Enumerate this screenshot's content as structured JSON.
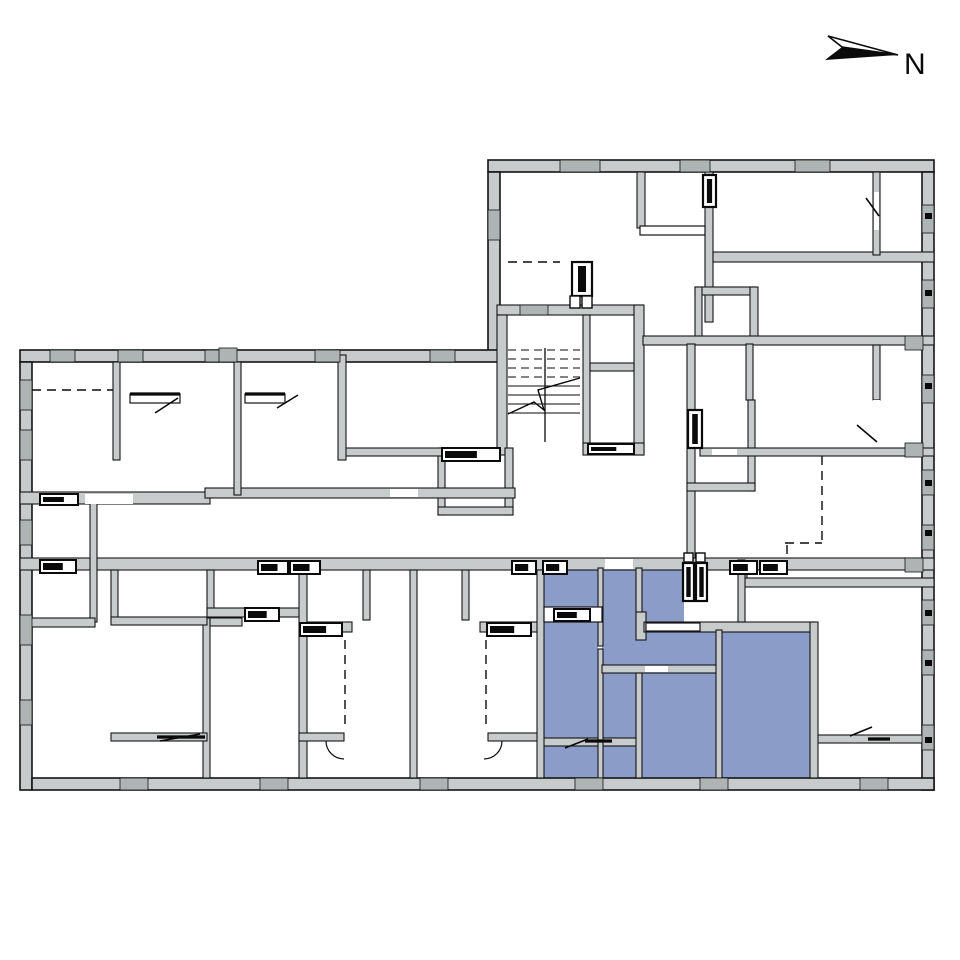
{
  "north": {
    "label": "N"
  },
  "colors": {
    "background": "#ffffff",
    "wall_fill": "#c7cbcc",
    "wall_outline": "#141414",
    "outer_window_fill": "#aeb3b4",
    "highlight": "#8c9cc9",
    "line_black": "#0a0a0a"
  },
  "plan": {
    "highlight_rects": [
      [
        544,
        570,
        140,
        52
      ],
      [
        544,
        622,
        54,
        116
      ],
      [
        602,
        622,
        114,
        50
      ],
      [
        602,
        672,
        36,
        66
      ],
      [
        642,
        672,
        74,
        106
      ],
      [
        722,
        630,
        88,
        148
      ],
      [
        544,
        742,
        96,
        36
      ]
    ],
    "outer_walls": [
      [
        488,
        160,
        446,
        12
      ],
      [
        922,
        172,
        12,
        618
      ],
      [
        488,
        172,
        12,
        180
      ],
      [
        20,
        350,
        478,
        12
      ],
      [
        20,
        362,
        12,
        428
      ],
      [
        32,
        778,
        902,
        12
      ]
    ],
    "inner_walls": [
      [
        497,
        305,
        145,
        10
      ],
      [
        497,
        315,
        10,
        140
      ],
      [
        583,
        315,
        7,
        130
      ],
      [
        634,
        305,
        10,
        150
      ],
      [
        590,
        363,
        44,
        8
      ],
      [
        583,
        443,
        61,
        12
      ],
      [
        438,
        448,
        7,
        67
      ],
      [
        505,
        448,
        8,
        67
      ],
      [
        438,
        507,
        75,
        8
      ],
      [
        342,
        448,
        104,
        8
      ],
      [
        637,
        172,
        8,
        56
      ],
      [
        705,
        172,
        8,
        150
      ],
      [
        713,
        252,
        221,
        10
      ],
      [
        873,
        172,
        7,
        83
      ],
      [
        695,
        287,
        60,
        8
      ],
      [
        695,
        287,
        7,
        57
      ],
      [
        750,
        287,
        8,
        57
      ],
      [
        643,
        336,
        291,
        9
      ],
      [
        687,
        344,
        8,
        216
      ],
      [
        746,
        344,
        7,
        56
      ],
      [
        748,
        400,
        7,
        91
      ],
      [
        687,
        483,
        68,
        8
      ],
      [
        873,
        345,
        7,
        55
      ],
      [
        700,
        448,
        234,
        8
      ],
      [
        740,
        560,
        7,
        26
      ],
      [
        744,
        578,
        190,
        9
      ],
      [
        20,
        492,
        190,
        12
      ],
      [
        205,
        488,
        310,
        10
      ],
      [
        20,
        558,
        914,
        12
      ],
      [
        90,
        498,
        7,
        124
      ],
      [
        30,
        618,
        65,
        9
      ],
      [
        203,
        618,
        7,
        160
      ],
      [
        210,
        618,
        32,
        8
      ],
      [
        113,
        362,
        7,
        98
      ],
      [
        234,
        362,
        7,
        133
      ],
      [
        338,
        355,
        8,
        105
      ],
      [
        111,
        570,
        7,
        52
      ],
      [
        111,
        617,
        96,
        8
      ],
      [
        207,
        570,
        7,
        47
      ],
      [
        207,
        608,
        95,
        9
      ],
      [
        299,
        570,
        8,
        208
      ],
      [
        363,
        570,
        7,
        50
      ],
      [
        410,
        570,
        7,
        208
      ],
      [
        462,
        570,
        7,
        50
      ],
      [
        307,
        622,
        45,
        10
      ],
      [
        480,
        622,
        58,
        10
      ],
      [
        111,
        733,
        96,
        8
      ],
      [
        299,
        733,
        45,
        8
      ],
      [
        488,
        733,
        50,
        8
      ],
      [
        540,
        738,
        100,
        8
      ],
      [
        815,
        735,
        108,
        8
      ],
      [
        537,
        570,
        7,
        208
      ],
      [
        598,
        568,
        5,
        78
      ],
      [
        598,
        649,
        5,
        129
      ],
      [
        636,
        568,
        6,
        46
      ],
      [
        636,
        612,
        10,
        28
      ],
      [
        644,
        622,
        170,
        10
      ],
      [
        602,
        665,
        116,
        8
      ],
      [
        636,
        673,
        6,
        105
      ],
      [
        716,
        630,
        6,
        148
      ],
      [
        810,
        622,
        8,
        156
      ],
      [
        738,
        560,
        7,
        62
      ]
    ],
    "outer_windows": [
      [
        560,
        160,
        40,
        12
      ],
      [
        680,
        160,
        30,
        12
      ],
      [
        795,
        160,
        35,
        12
      ],
      [
        922,
        205,
        12,
        28
      ],
      [
        922,
        280,
        12,
        28
      ],
      [
        922,
        375,
        12,
        28
      ],
      [
        922,
        470,
        12,
        25
      ],
      [
        922,
        525,
        12,
        25
      ],
      [
        922,
        600,
        12,
        25
      ],
      [
        922,
        650,
        12,
        25
      ],
      [
        922,
        725,
        12,
        25
      ],
      [
        20,
        380,
        12,
        30
      ],
      [
        20,
        430,
        12,
        30
      ],
      [
        20,
        520,
        12,
        25
      ],
      [
        20,
        615,
        12,
        30
      ],
      [
        20,
        700,
        12,
        25
      ],
      [
        50,
        350,
        25,
        12
      ],
      [
        118,
        350,
        25,
        12
      ],
      [
        205,
        350,
        28,
        12
      ],
      [
        315,
        350,
        25,
        12
      ],
      [
        430,
        350,
        25,
        12
      ],
      [
        120,
        778,
        28,
        12
      ],
      [
        260,
        778,
        28,
        12
      ],
      [
        420,
        778,
        28,
        12
      ],
      [
        575,
        778,
        28,
        12
      ],
      [
        700,
        778,
        28,
        12
      ],
      [
        860,
        778,
        28,
        12
      ],
      [
        488,
        210,
        12,
        30
      ],
      [
        905,
        336,
        18,
        14
      ],
      [
        905,
        443,
        18,
        14
      ],
      [
        905,
        558,
        18,
        14
      ],
      [
        219,
        348,
        18,
        14
      ],
      [
        520,
        305,
        28,
        10
      ]
    ],
    "wall_ticks": [
      [
        925,
        213,
        7,
        6
      ],
      [
        925,
        290,
        7,
        6
      ],
      [
        925,
        383,
        7,
        6
      ],
      [
        925,
        480,
        7,
        6
      ],
      [
        925,
        530,
        7,
        6
      ],
      [
        925,
        610,
        7,
        6
      ],
      [
        925,
        660,
        7,
        6
      ],
      [
        925,
        737,
        7,
        6
      ]
    ],
    "door_gaps": [
      [
        390,
        489,
        28,
        8
      ],
      [
        85,
        494,
        48,
        10
      ],
      [
        605,
        559,
        28,
        10
      ],
      [
        645,
        666,
        23,
        6
      ],
      [
        712,
        449,
        25,
        6
      ],
      [
        874,
        192,
        5,
        38
      ],
      [
        873,
        400,
        7,
        42
      ]
    ],
    "sills": [
      [
        544,
        607,
        58,
        15
      ],
      [
        646,
        623,
        54,
        8
      ],
      [
        640,
        226,
        65,
        9
      ],
      [
        130,
        394,
        50,
        9
      ],
      [
        245,
        394,
        40,
        9
      ]
    ],
    "framed_windows": [
      [
        40,
        494,
        38,
        11
      ],
      [
        40,
        560,
        36,
        13
      ],
      [
        258,
        561,
        30,
        13
      ],
      [
        290,
        561,
        30,
        13
      ],
      [
        512,
        561,
        24,
        13
      ],
      [
        543,
        561,
        24,
        13
      ],
      [
        730,
        561,
        27,
        13
      ],
      [
        760,
        561,
        27,
        13
      ],
      [
        245,
        608,
        34,
        13
      ],
      [
        300,
        623,
        42,
        13
      ],
      [
        487,
        623,
        44,
        13
      ],
      [
        442,
        448,
        58,
        13
      ],
      [
        554,
        609,
        36,
        12
      ],
      [
        588,
        444,
        46,
        10
      ]
    ],
    "vents": [
      [
        688,
        410,
        14,
        38
      ],
      [
        683,
        563,
        11,
        38
      ],
      [
        696,
        563,
        11,
        38
      ],
      [
        703,
        175,
        13,
        32
      ],
      [
        572,
        262,
        20,
        34
      ]
    ],
    "small_boxes": [
      [
        570,
        296,
        10,
        12
      ],
      [
        582,
        296,
        10,
        12
      ],
      [
        684,
        553,
        9,
        9
      ],
      [
        696,
        553,
        9,
        9
      ]
    ],
    "dashed_lines": [
      [
        32,
        390,
        113,
        390
      ],
      [
        508,
        262,
        560,
        262
      ],
      [
        822,
        456,
        822,
        543
      ],
      [
        785,
        543,
        822,
        543
      ],
      [
        787,
        545,
        787,
        570
      ],
      [
        345,
        640,
        345,
        728
      ],
      [
        486,
        640,
        486,
        728
      ]
    ],
    "door_leaves": [
      [
        155,
        413,
        178,
        398
      ],
      [
        277,
        408,
        298,
        395
      ],
      [
        866,
        198,
        879,
        216
      ],
      [
        857,
        425,
        877,
        442
      ],
      [
        160,
        741,
        200,
        734
      ],
      [
        565,
        748,
        588,
        739
      ],
      [
        850,
        736,
        872,
        727
      ]
    ],
    "black_lines": [
      [
        157,
        737,
        205,
        737
      ],
      [
        585,
        741,
        612,
        741
      ],
      [
        868,
        739,
        890,
        739
      ],
      [
        130,
        394,
        180,
        394
      ],
      [
        245,
        394,
        285,
        394
      ]
    ],
    "door_arcs": [
      "M 326 741 A 18 18 0 0 0 344 759",
      "M 502 741 A 18 18 0 0 1 484 759"
    ],
    "stairs": {
      "x1": 508,
      "x2": 580,
      "y_start": 350,
      "steps": 8,
      "dy": 9,
      "dashed_steps": 4,
      "divider_x": 545,
      "divider_y1": 348,
      "divider_y2": 442,
      "break_line": "508,414 534,402 544,410 538,390 580,378"
    },
    "north_arrow": {
      "outline_triangle": "828,36 898,55 842,47",
      "filled_triangle": "825,60 898,55 842,47",
      "label_x": 904,
      "label_y": 74,
      "label_size": 30
    }
  }
}
